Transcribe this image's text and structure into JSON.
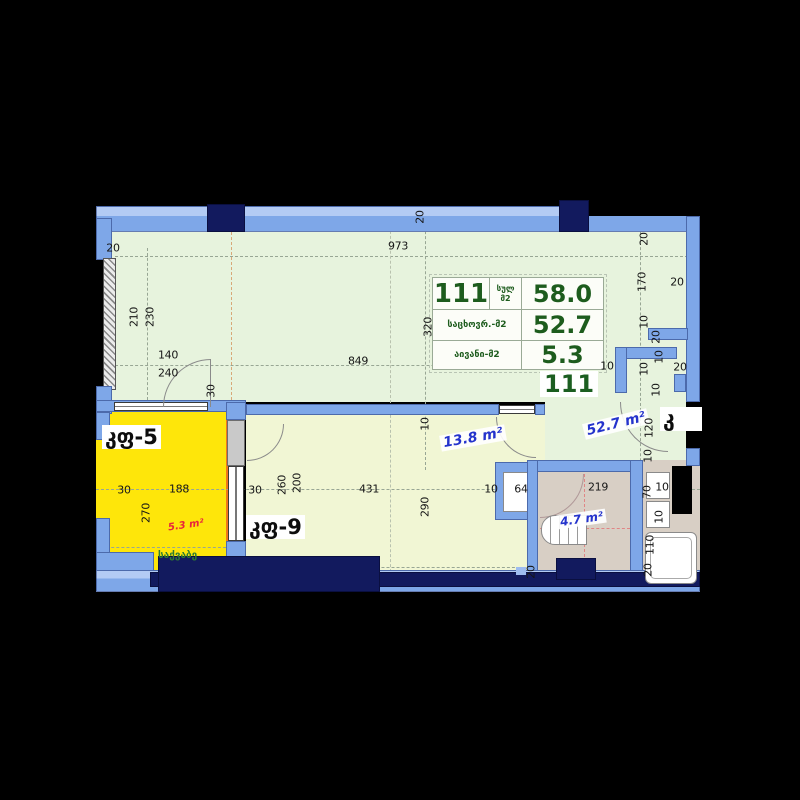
{
  "unit_table": {
    "number": "111",
    "total_label": "სულ",
    "total_unit": "მ2",
    "total_value": "58.0",
    "living_label": "საცხოვრ.-მ2",
    "living_value": "52.7",
    "balcony_label": "აივანი-მ2",
    "balcony_value": "5.3"
  },
  "unit_number_tag": "111",
  "room_labels": {
    "door_window_5": "კფ-5",
    "door_window_9": "კფ-9",
    "door_window_cut": "კ",
    "boiler_room": "საქვაბე"
  },
  "area_labels": {
    "living": "52.7 m²",
    "hall": "13.8 m²",
    "bathroom": "4.7 m²",
    "balcony": "5.3 m²"
  },
  "colors": {
    "wall_blue": "#7ea7e8",
    "column_navy": "#121a5e",
    "living_room_fill": "#e7f3dd",
    "hall_fill": "#f1f6d4",
    "balcony_fill": "#fee60a",
    "bathroom_fill": "#d8cfc5",
    "table_text_green": "#1d5c1d",
    "area_text_blue": "#2433cc",
    "area_text_red": "#e8243c"
  },
  "annotations": [
    {
      "t": "20",
      "x": 113,
      "y": 248
    },
    {
      "t": "973",
      "x": 398,
      "y": 246
    },
    {
      "t": "20",
      "x": 420,
      "y": 217,
      "r": -90
    },
    {
      "t": "210",
      "x": 134,
      "y": 317,
      "r": -90
    },
    {
      "t": "230",
      "x": 150,
      "y": 317,
      "r": -90
    },
    {
      "t": "140",
      "x": 168,
      "y": 355
    },
    {
      "t": "240",
      "x": 168,
      "y": 373
    },
    {
      "t": "30",
      "x": 211,
      "y": 391,
      "r": -90
    },
    {
      "t": "849",
      "x": 358,
      "y": 361
    },
    {
      "t": "320",
      "x": 428,
      "y": 327,
      "r": -90
    },
    {
      "t": "20",
      "x": 644,
      "y": 239,
      "r": -90
    },
    {
      "t": "170",
      "x": 642,
      "y": 282,
      "r": -90
    },
    {
      "t": "20",
      "x": 677,
      "y": 282
    },
    {
      "t": "10",
      "x": 644,
      "y": 322,
      "r": -90
    },
    {
      "t": "20",
      "x": 656,
      "y": 337,
      "r": -90
    },
    {
      "t": "10",
      "x": 659,
      "y": 357,
      "r": -90
    },
    {
      "t": "10",
      "x": 644,
      "y": 369,
      "r": -90
    },
    {
      "t": "20",
      "x": 680,
      "y": 367
    },
    {
      "t": "10",
      "x": 607,
      "y": 366
    },
    {
      "t": "10",
      "x": 656,
      "y": 390,
      "r": -90
    },
    {
      "t": "120",
      "x": 649,
      "y": 428,
      "r": -90
    },
    {
      "t": "10",
      "x": 648,
      "y": 456,
      "r": -90
    },
    {
      "t": "10",
      "x": 425,
      "y": 424,
      "r": -90
    },
    {
      "t": "30",
      "x": 124,
      "y": 490
    },
    {
      "t": "188",
      "x": 179,
      "y": 489
    },
    {
      "t": "270",
      "x": 146,
      "y": 513,
      "r": -90
    },
    {
      "t": "30",
      "x": 255,
      "y": 490
    },
    {
      "t": "260",
      "x": 282,
      "y": 485,
      "r": -90
    },
    {
      "t": "200",
      "x": 297,
      "y": 483,
      "r": -90
    },
    {
      "t": "431",
      "x": 369,
      "y": 489
    },
    {
      "t": "290",
      "x": 425,
      "y": 507,
      "r": -90
    },
    {
      "t": "10",
      "x": 491,
      "y": 489
    },
    {
      "t": "64",
      "x": 521,
      "y": 489
    },
    {
      "t": "219",
      "x": 598,
      "y": 487
    },
    {
      "t": "70",
      "x": 647,
      "y": 492,
      "r": -90
    },
    {
      "t": "10",
      "x": 662,
      "y": 487
    },
    {
      "t": "10",
      "x": 659,
      "y": 517,
      "r": -90
    },
    {
      "t": "110",
      "x": 650,
      "y": 545,
      "r": -90
    },
    {
      "t": "20",
      "x": 648,
      "y": 570,
      "r": -90
    },
    {
      "t": "20",
      "x": 531,
      "y": 572,
      "r": -90
    }
  ]
}
